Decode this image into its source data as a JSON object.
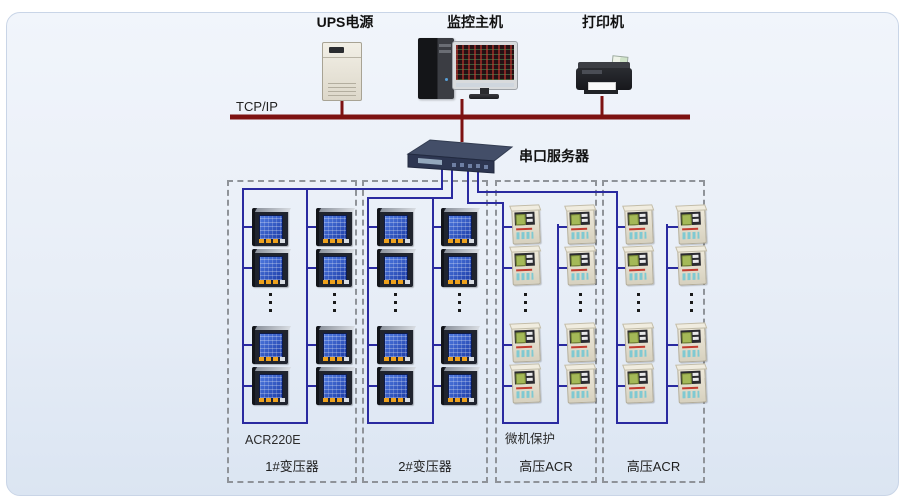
{
  "top_devices": [
    {
      "id": "ups",
      "label": "UPS电源"
    },
    {
      "id": "host",
      "label": "监控主机"
    },
    {
      "id": "printer",
      "label": "打印机"
    }
  ],
  "network": {
    "bus_label": "TCP/IP",
    "serial_server_label": "串口服务器",
    "bus_color": "#7d1212",
    "wire_color": "#2a2aa0"
  },
  "boxes": [
    {
      "top_label": "ACR220E",
      "bottom_label": "1#变压器",
      "device_type": "power-meter",
      "columns": 2,
      "meters_shown_per_column": 4,
      "ellipsis": true
    },
    {
      "top_label": "",
      "bottom_label": "2#变压器",
      "device_type": "power-meter",
      "columns": 2,
      "meters_shown_per_column": 4,
      "ellipsis": true
    },
    {
      "top_label": "微机保护",
      "bottom_label": "高压ACR",
      "device_type": "protection-relay",
      "columns": 2,
      "meters_shown_per_column": 4,
      "ellipsis": true
    },
    {
      "top_label": "",
      "bottom_label": "高压ACR",
      "device_type": "protection-relay",
      "columns": 2,
      "meters_shown_per_column": 4,
      "ellipsis": true
    }
  ]
}
